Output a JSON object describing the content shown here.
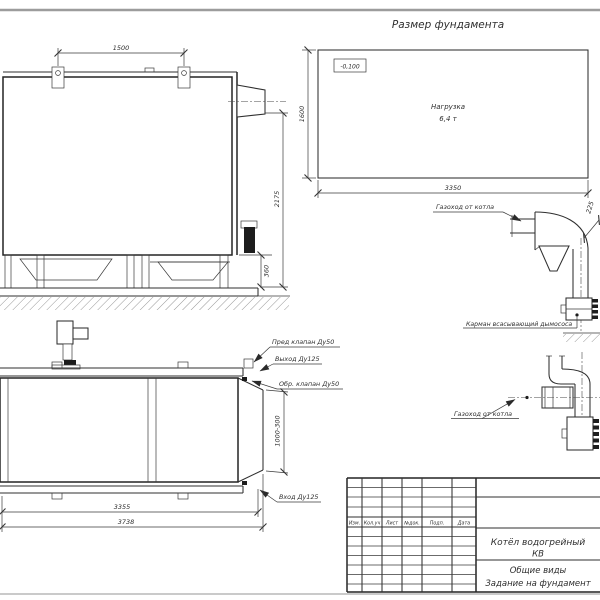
{
  "page": {
    "title": "Размер фундамента"
  },
  "foundation_plan": {
    "elevation_mark": "-0,100",
    "load_line1": "Нагрузка",
    "load_line2": "6,4 т",
    "dim_width": "3350",
    "dim_depth": "1600"
  },
  "boiler_side_view": {
    "dim_lug_spacing": "1500",
    "dim_height": "2175",
    "dim_base_height": "360"
  },
  "boiler_plan_view": {
    "label_safety_valve": "Пред клапан Ду50",
    "label_outlet": "Выход Ду125",
    "label_check_valve": "Обр. клапан Ду50",
    "label_inlet": "Вход Ду125",
    "dim_length_body": "3355",
    "dim_length_total": "3738",
    "dim_rear_section": "1000-300"
  },
  "flue_side_view": {
    "label_flue": "Газоход от котла",
    "label_pocket": "Карман всасывающий дымососа",
    "dim_offset": "225"
  },
  "flue_plan_view": {
    "label_flue": "Газоход от котла"
  },
  "title_block": {
    "columns": [
      "Изм.",
      "Кол.уч",
      "Лист",
      "№док.",
      "Подп.",
      "Дата"
    ],
    "product_name_line1": "Котёл водогрейный",
    "product_name_line2": "КВ",
    "doc_type_line1": "Общие виды",
    "doc_type_line2": "Задание на фундамент"
  },
  "colors": {
    "line": "#2f2f2f",
    "sheet_edge": "#9c9c9c",
    "background": "#ffffff"
  }
}
